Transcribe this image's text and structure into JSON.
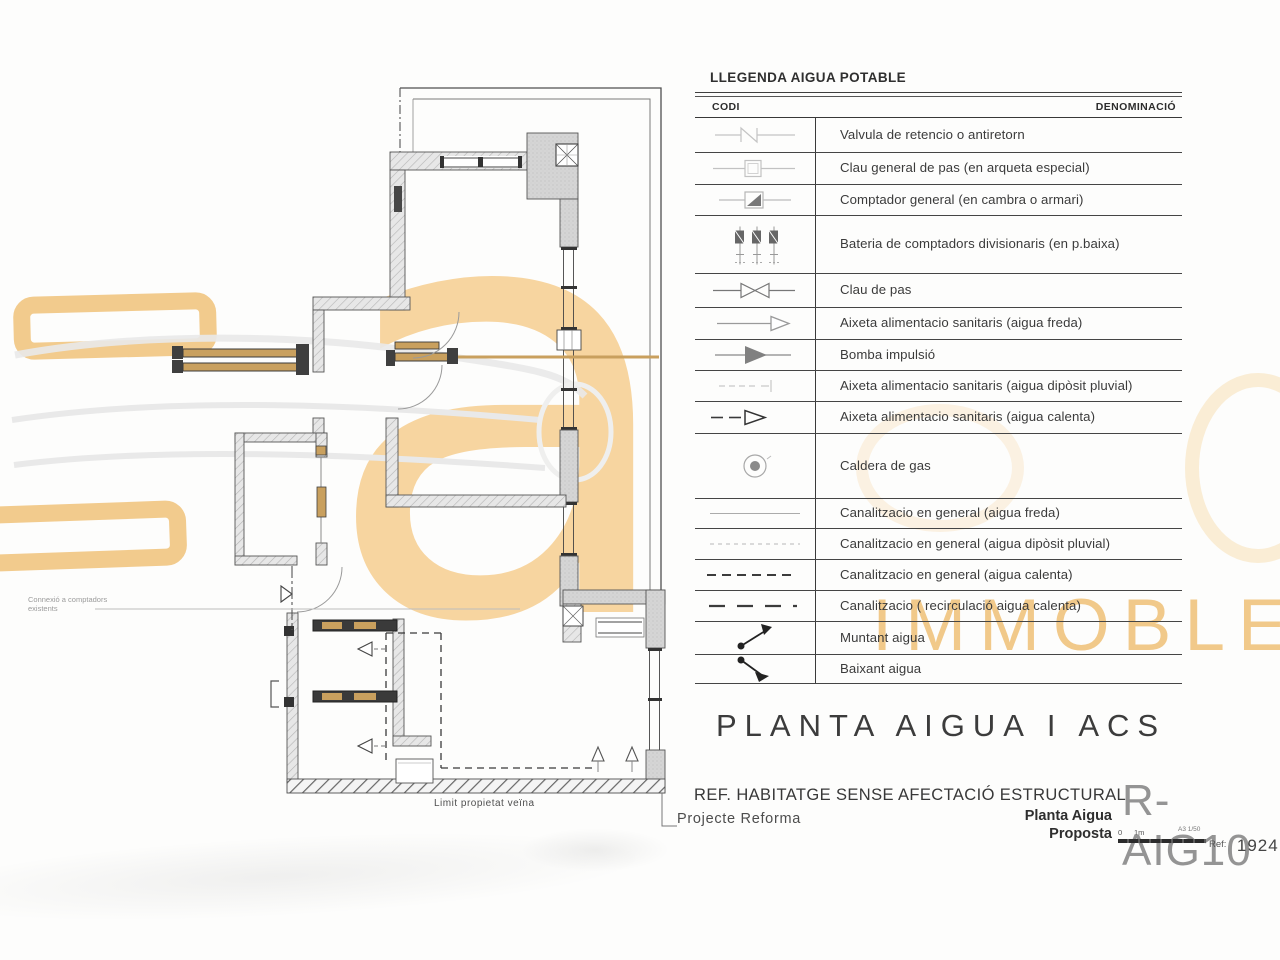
{
  "legend": {
    "title": "LLEGENDA AIGUA POTABLE",
    "col_codi": "CODI",
    "col_denominacio": "DENOMINACIÓ",
    "rows": [
      {
        "symbol": "check-valve",
        "label": "Valvula de retencio o antiretorn"
      },
      {
        "symbol": "general-shutoff-valve",
        "label": "Clau general de pas (en arqueta especial)"
      },
      {
        "symbol": "general-meter",
        "label": "Comptador general (en cambra o armari)"
      },
      {
        "symbol": "meter-battery",
        "label": "Bateria de comptadors divisionaris (en p.baixa)"
      },
      {
        "symbol": "shutoff-valve",
        "label": "Clau de pas"
      },
      {
        "symbol": "tap-cold-water",
        "label": "Aixeta alimentacio sanitaris (aigua freda)"
      },
      {
        "symbol": "impulsion-pump",
        "label": "Bomba impulsió"
      },
      {
        "symbol": "tap-rain-water",
        "label": "Aixeta alimentacio sanitaris (aigua dipòsit pluvial)"
      },
      {
        "symbol": "tap-hot-water",
        "label": "Aixeta alimentacio sanitaris (aigua calenta)"
      },
      {
        "symbol": "gas-boiler",
        "label": "Caldera de gas"
      },
      {
        "symbol": "pipe-cold-water",
        "label": "Canalitzacio en general (aigua freda)"
      },
      {
        "symbol": "pipe-rain-water",
        "label": "Canalitzacio en general (aigua dipòsit pluvial)"
      },
      {
        "symbol": "pipe-hot-water",
        "label": "Canalitzacio en general (aigua calenta)"
      },
      {
        "symbol": "pipe-recirculation",
        "label": "Canalitzacio ( recirculació aigua calenta)"
      },
      {
        "symbol": "riser-up-arrow",
        "label": "Muntant aigua"
      },
      {
        "symbol": "riser-down-arrow",
        "label": "Baixant aigua"
      }
    ]
  },
  "plan": {
    "annotation_connexio_line1": "Connexió a comptadors",
    "annotation_connexio_line2": "existents",
    "annotation_limit": "Limit propietat veïna"
  },
  "titleblock": {
    "title": "PLANTA AIGUA I ACS",
    "ref_line": "REF. HABITATGE SENSE AFECTACIÓ ESTRUCTURAL",
    "project": "Projecte Reforma",
    "sheet_name_1": "Planta Aigua",
    "sheet_name_2": "Proposta",
    "code": "R-AIG10",
    "scale_zero": "0",
    "scale_unit": "1m",
    "scale_note": "A3 1/50",
    "ref_label": "Ref:",
    "ref_number": "1924"
  },
  "watermark": {
    "brand_letter": "a",
    "brand_word": "IMMOBLE",
    "accent_orange": "#f2cb8d",
    "letter_orange": "#f7d5a0",
    "word_orange": "#f1c98a"
  }
}
